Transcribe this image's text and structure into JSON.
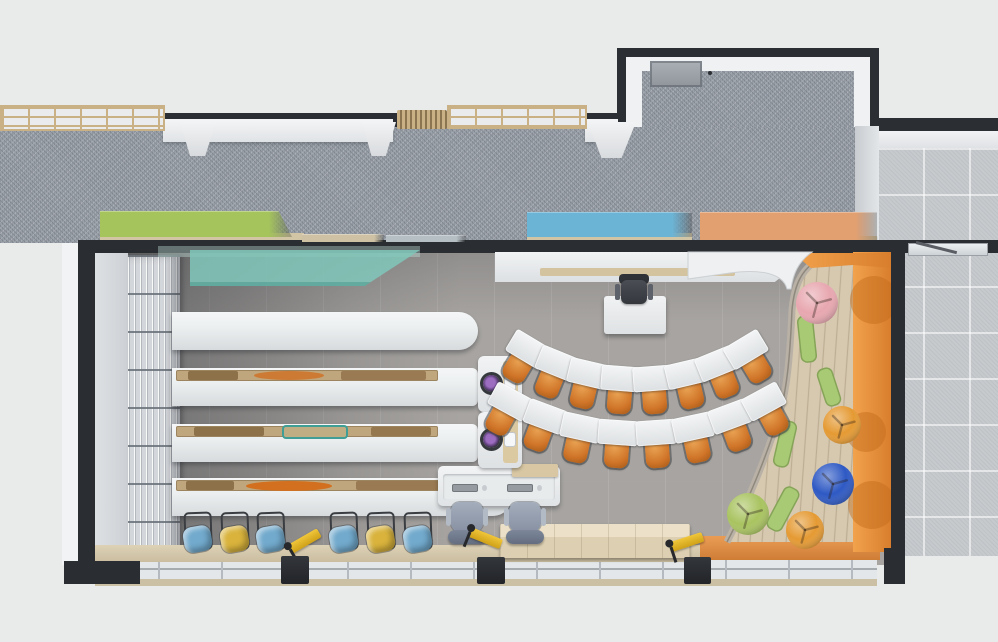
{
  "scene": {
    "kind": "floor-plan-3d-render",
    "view": "top-down",
    "space": "school library classroom"
  },
  "palette": {
    "background": "#e9ebea",
    "wall_dark": "#2a2d31",
    "corridor_floor": "#9ba1a9",
    "room_floor": "#a7a4a1",
    "tile_floor": "#c6cacd",
    "wood_light": "#d2c5a6",
    "white_surface": "#eef0f1",
    "accent_green": "#a5c45c",
    "accent_teal": "#80c7ba",
    "accent_blue": "#6cb4d6",
    "accent_orange": "#e2a070",
    "orange_wall": "#e08838",
    "chair_orange": "#d2772e",
    "stool_blue": "#72aacd",
    "stool_yellow": "#d9b33c",
    "pouf_pink": "#e8a7b0",
    "pouf_blue": "#2e59c4",
    "pouf_orange": "#e59a33",
    "pouf_green": "#a9c360",
    "cushion_green": "#a8ca74"
  },
  "corridor": {
    "skylights": [
      {
        "x": 0,
        "y": 105,
        "w": 165,
        "h": 26
      },
      {
        "x": 447,
        "y": 105,
        "w": 140,
        "h": 24
      }
    ],
    "vent": {
      "x": 397,
      "y": 110,
      "w": 50,
      "h": 19
    },
    "ledges": [
      {
        "x": 163,
        "y": 119,
        "w": 230,
        "h": 23
      },
      {
        "x": 585,
        "y": 119,
        "w": 33,
        "h": 23
      }
    ],
    "brackets": [
      {
        "x": 180,
        "y": 122,
        "w": 36,
        "h": 34
      },
      {
        "x": 362,
        "y": 122,
        "w": 34,
        "h": 34
      },
      {
        "x": 588,
        "y": 122,
        "w": 48,
        "h": 36
      }
    ]
  },
  "hall_door": {
    "x": 908,
    "y": 243,
    "w": 80,
    "h": 13
  },
  "wall_benches": [
    {
      "name": "green-wall-bench",
      "x": 100,
      "y": 211,
      "w": 192,
      "h": 26,
      "color": "#a5c45c",
      "angled_right": true,
      "base": {
        "x": 100,
        "w": 204
      }
    },
    {
      "name": "wood-ledge",
      "x": 302,
      "y": 234,
      "w": 82,
      "h": 8,
      "color": "#cfc2a4"
    },
    {
      "name": "flat-glass-panel",
      "x": 386,
      "y": 235,
      "w": 80,
      "h": 7,
      "color": "#b6bfc3"
    },
    {
      "name": "blue-wall-bench",
      "x": 527,
      "y": 212,
      "w": 165,
      "h": 25,
      "color": "#6cb4d6",
      "base": {
        "x": 527,
        "w": 165
      }
    },
    {
      "name": "orange-wall-bench",
      "x": 700,
      "y": 212,
      "w": 177,
      "h": 28,
      "color": "#e2a070",
      "base": {
        "x": 700,
        "w": 177
      }
    }
  ],
  "tables": [
    {
      "name": "display-table-1",
      "x": 172,
      "y": 312,
      "w": 306,
      "h": 38,
      "rounded_right": 20,
      "contents": []
    },
    {
      "name": "display-table-2",
      "x": 172,
      "y": 368,
      "w": 306,
      "h": 38,
      "rounded_right": 6,
      "device": true,
      "device_y": 356,
      "contents": [
        {
          "x": 12,
          "w": 50,
          "h": 9,
          "color": "#8d7148",
          "shape": "rect"
        },
        {
          "x": 78,
          "w": 70,
          "h": 9,
          "color": "#cd7a35",
          "shape": "ellipse"
        },
        {
          "x": 165,
          "w": 85,
          "h": 9,
          "color": "#9a7a52",
          "shape": "rect"
        }
      ]
    },
    {
      "name": "display-table-3",
      "x": 172,
      "y": 424,
      "w": 306,
      "h": 38,
      "rounded_right": 6,
      "device": true,
      "device_y": 412,
      "contents": [
        {
          "x": 18,
          "w": 70,
          "h": 9,
          "color": "#8d7148",
          "shape": "rect"
        },
        {
          "x": 108,
          "w": 62,
          "h": 10,
          "color": "#bfae84",
          "shape": "rect",
          "border": "#3f9e96"
        },
        {
          "x": 195,
          "w": 60,
          "h": 9,
          "color": "#96784f",
          "shape": "rect"
        }
      ]
    },
    {
      "name": "display-table-4",
      "x": 172,
      "y": 478,
      "w": 340,
      "h": 38,
      "rounded_right": 20,
      "contents": [
        {
          "x": 10,
          "w": 48,
          "h": 9,
          "color": "#8d7148",
          "shape": "rect"
        },
        {
          "x": 70,
          "w": 86,
          "h": 10,
          "color": "#d2701f",
          "shape": "ellipse"
        },
        {
          "x": 180,
          "w": 100,
          "h": 9,
          "color": "#9a7a52",
          "shape": "rect"
        }
      ]
    }
  ],
  "desk_arcs": {
    "focal_x": 637,
    "focal_y": 168,
    "desk_w": 40,
    "desk_h": 25,
    "arcs": [
      {
        "radius": 212,
        "count": 8,
        "start_deg": -31,
        "end_deg": 31
      },
      {
        "radius": 266,
        "count": 8,
        "start_deg": -28.5,
        "end_deg": 28.5
      }
    ]
  },
  "teacher": {
    "chair": {
      "x": 615,
      "y": 274,
      "w": 38,
      "h": 32
    },
    "desk": {
      "x": 604,
      "y": 296,
      "w": 62,
      "h": 38
    }
  },
  "computer_station": {
    "desk": {
      "x": 438,
      "y": 466,
      "w": 122,
      "h": 40
    },
    "keyboards": [
      452,
      507
    ],
    "tray": {
      "x": 512,
      "w": 46
    },
    "chairs": [
      {
        "x": 448,
        "y": 500
      },
      {
        "x": 506,
        "y": 500
      }
    ]
  },
  "credenza": {
    "x": 500,
    "y": 524,
    "w": 190,
    "h": 34
  },
  "stools": {
    "y": 518,
    "items": [
      {
        "x": 183,
        "color": "#72aacd"
      },
      {
        "x": 220,
        "color": "#d9b33c"
      },
      {
        "x": 256,
        "color": "#72aacd"
      },
      {
        "x": 329,
        "color": "#72aacd"
      },
      {
        "x": 366,
        "color": "#d9b33c"
      },
      {
        "x": 403,
        "color": "#72aacd"
      }
    ]
  },
  "window_wall": {
    "pillars": [
      {
        "x": 281,
        "y": 556,
        "w": 28,
        "h": 28
      },
      {
        "x": 477,
        "y": 557,
        "w": 28,
        "h": 27
      },
      {
        "x": 684,
        "y": 557,
        "w": 27,
        "h": 27
      }
    ],
    "stands": [
      {
        "x": 284,
        "y": 533,
        "rot": -30
      },
      {
        "x": 464,
        "y": 530,
        "rot": 22
      },
      {
        "x": 666,
        "y": 534,
        "rot": -18
      }
    ]
  },
  "reading_corner": {
    "platform_path": "M 818,260 C 800,270 794,288 792,310 C 790,356 787,394 777,422 C 766,457 748,502 727,542 L 889,542 L 889,260 Z",
    "rim_path": "M 818,260 C 800,270 794,288 792,310 C 790,356 787,394 777,422 C 766,457 748,502 727,542",
    "counter_path": "M 688,252 L 812,252 C 798,262 793,274 791,289 L 787,289 C 783,273 760,269 730,273 L 688,279 Z",
    "corner_wedge": "M 793,253 L 891,253 L 891,268 L 853,265 L 811,268 Z",
    "orange_wall": {
      "x": 853,
      "y": 252,
      "w": 38,
      "h": 300
    },
    "wall_dots": [
      {
        "cx": 874,
        "cy": 300,
        "r": 24
      },
      {
        "cx": 866,
        "cy": 432,
        "r": 20
      },
      {
        "cx": 872,
        "cy": 505,
        "r": 24
      }
    ],
    "cushions": [
      {
        "cx": 807,
        "cy": 339,
        "w": 15,
        "h": 46,
        "rot": -6
      },
      {
        "cx": 829,
        "cy": 387,
        "w": 15,
        "h": 38,
        "rot": -18
      },
      {
        "cx": 785,
        "cy": 444,
        "w": 15,
        "h": 46,
        "rot": 13
      },
      {
        "cx": 783,
        "cy": 509,
        "w": 16,
        "h": 46,
        "rot": 28
      }
    ],
    "poufs": [
      {
        "name": "pouf-pink",
        "cx": 817,
        "cy": 303,
        "r": 21,
        "color": "#e8a7b0"
      },
      {
        "name": "pouf-orange-upper",
        "cx": 842,
        "cy": 425,
        "r": 19,
        "color": "#e59a33"
      },
      {
        "name": "pouf-blue",
        "cx": 833,
        "cy": 484,
        "r": 21,
        "color": "#2e59c4"
      },
      {
        "name": "pouf-orange-lower",
        "cx": 805,
        "cy": 530,
        "r": 19,
        "color": "#e59a33"
      },
      {
        "name": "pouf-green",
        "cx": 748,
        "cy": 514,
        "r": 21,
        "color": "#a9c360"
      }
    ]
  }
}
